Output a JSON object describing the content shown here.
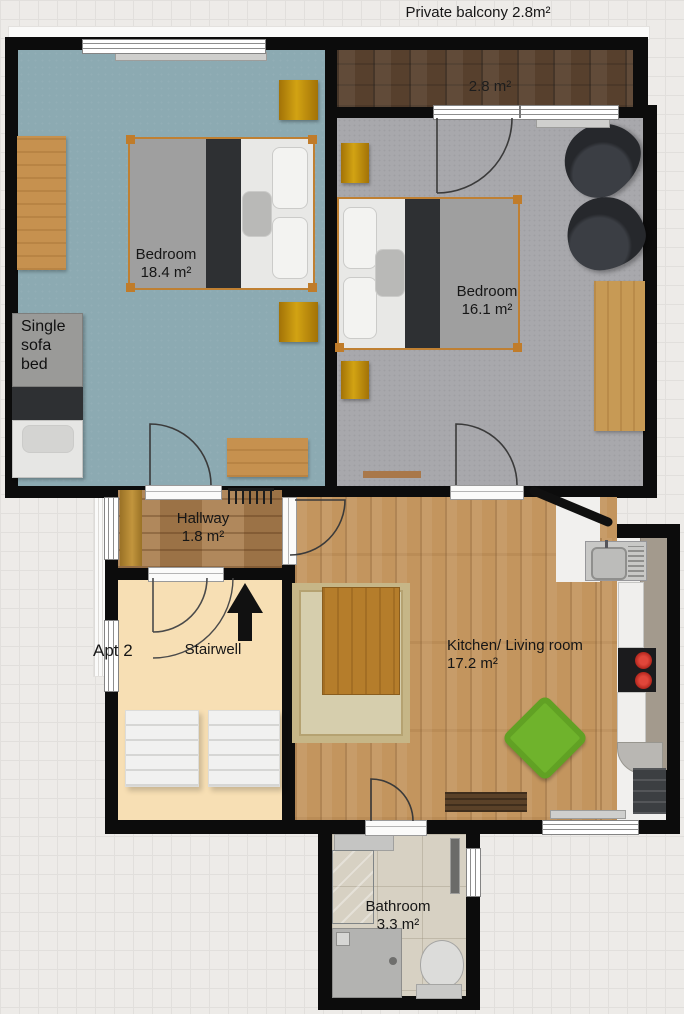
{
  "title": "Private balcony 2.8m²",
  "rooms": {
    "balcony": {
      "area": "2.8 m²"
    },
    "bedroom_left": {
      "name": "Bedroom",
      "area": "18.4 m²"
    },
    "bedroom_right": {
      "name": "Bedroom",
      "area": "16.1 m²"
    },
    "hallway": {
      "name": "Hallway",
      "area": "1.8 m²"
    },
    "stairwell": {
      "name": "Stairwell"
    },
    "kitchen_living": {
      "name": "Kitchen/ Living room",
      "area": "17.2 m²"
    },
    "bathroom": {
      "name": "Bathroom",
      "area": "3.3 m²"
    }
  },
  "labels": {
    "apartment": "Apt 2",
    "single_sofa_bed": "Single sofa bed"
  },
  "colors": {
    "wall": "#0c0c0c",
    "bedroom_left_floor": "#8caab2",
    "bedroom_right_floor": "#a8a8ac",
    "balcony_floor": "#57402d",
    "hallway_floor": "#a87c4c",
    "stairwell_floor": "#f7dfb4",
    "kitchen_floor": "#c3955e",
    "bathroom_floor": "#d7d1c3",
    "beanbag_green": "#6fb32c",
    "stool_gold": "#c28a10",
    "stove_burner_red": "#c62b22"
  }
}
